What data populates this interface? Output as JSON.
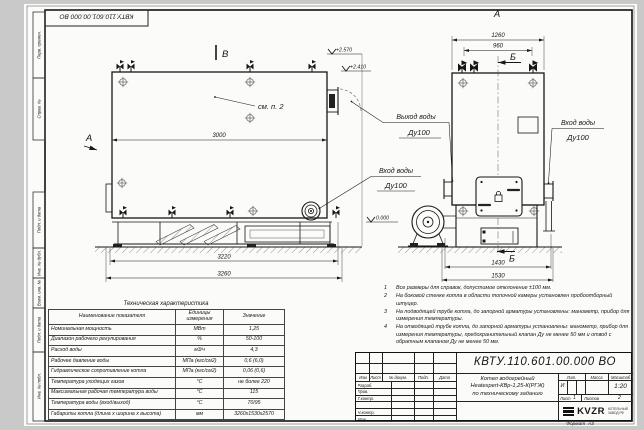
{
  "colors": {
    "paper": "#fbfbfa",
    "line": "#161616",
    "margin_bg": "#c9c9c9"
  },
  "stamp_top": "КВТУ.110.601.00.000 ВО",
  "sidebar": {
    "perv_primen": "Перв. примен.",
    "sprav_no": "Справ. №",
    "podp_data_1": "Подп. и дата",
    "inv_dubl": "Инв. № дубл.",
    "vzam_inv": "Взам. инв. №",
    "podp_data_2": "Подп. и дата",
    "inv_podl": "Инв. № подл."
  },
  "drawing": {
    "side_view": {
      "section_b": "В",
      "view_a": "А",
      "see_note": "см. п. 2",
      "dim_width": "3000",
      "dim_base": "3220",
      "dim_total": "3260",
      "elev_top": "+2.570",
      "elev_upper": "+2.410",
      "elev_zero": "0.000",
      "inlet_title": "Вход воды",
      "inlet_dn": "Ду100"
    },
    "front_view": {
      "view_label": "А",
      "section_b": "Б",
      "dim_width_total": "1260",
      "dim_valves": "960",
      "dim_depth": "1430",
      "dim_depth_total": "1530",
      "outlet_title": "Выход воды",
      "outlet_dn": "Ду100",
      "inlet_title": "Вход воды",
      "inlet_dn": "Ду100"
    }
  },
  "spec_table": {
    "title": "Техническая характеристика",
    "headers": [
      "Наименование показателя",
      "Единицы измерения",
      "Значение"
    ],
    "rows": [
      {
        "name": "Номинальная мощность",
        "unit": "МВт",
        "value": "1,25"
      },
      {
        "name": "Диапазон рабочего регулирования",
        "unit": "%",
        "value": "50-100"
      },
      {
        "name": "Расход воды",
        "unit": "м3/ч",
        "value": "4,3"
      },
      {
        "name": "Рабочее давление воды",
        "unit": "МПа (кгс/см2)",
        "value": "0,6 (6,0)"
      },
      {
        "name": "Гидравлическое сопротивление котла",
        "unit": "МПа (кгс/см2)",
        "value": "0,06 (0,6)"
      },
      {
        "name": "Температура уходящих газов",
        "unit": "°С",
        "value": "не более 220"
      },
      {
        "name": "Максимальная рабочая температура воды",
        "unit": "°С",
        "value": "115"
      },
      {
        "name": "Температура воды (вход/выход)",
        "unit": "°С",
        "value": "70/95"
      },
      {
        "name": "Габариты котла (длина х ширина х высота)",
        "unit": "мм",
        "value": "3260х1530х2570"
      }
    ]
  },
  "notes": [
    {
      "num": "1",
      "text": "Все размеры для справок, допустимое отклонение ±100 мм."
    },
    {
      "num": "2",
      "text": "На боковой стенке котла в области топочной камеры установлен пробоотборный штуцер."
    },
    {
      "num": "3",
      "text": "На подводящей трубе котла, до запорной арматуры установлены: манометр, прибор для измерения температуры."
    },
    {
      "num": "4",
      "text": "На отводящей трубе котла, до запорной арматуры установлены: манометр, прибор для измерения температуры, предохранительный клапан Ду не менее 50 мм и отвод с обратным клапаном Ду не менее 50 мм."
    }
  ],
  "title_block": {
    "doc_number": "КВТУ.110.601.00.000 ВО",
    "name_line1": "Котел водогрейный",
    "name_line2": "Heatexpert-КВр-1,25-К(РГЖ)",
    "name_line3": "по техническому заданию",
    "col_izm": "Изм",
    "col_list": "Лист",
    "col_docum": "№ докум.",
    "col_podp": "Подп.",
    "col_data": "Дата",
    "row_razrab": "Разраб.",
    "row_prov": "Пров.",
    "row_tkontr": "Т.контр.",
    "row_nkontr": "Н.контр.",
    "row_utv": "Утв.",
    "lit_label": "Лит.",
    "lit_value": "И",
    "massa_label": "Масса",
    "masshtab_label": "Масштаб",
    "masshtab_value": "1:20",
    "list_label": "Лист",
    "list_value": "1",
    "listov_label": "Листов",
    "listov_value": "2",
    "logo_text": "KVZR",
    "logo_sub1": "КОТЕЛЬНЫЙ",
    "logo_sub2": "ЗАВОД РФ",
    "format_label": "Формат",
    "format_value": "А3"
  }
}
